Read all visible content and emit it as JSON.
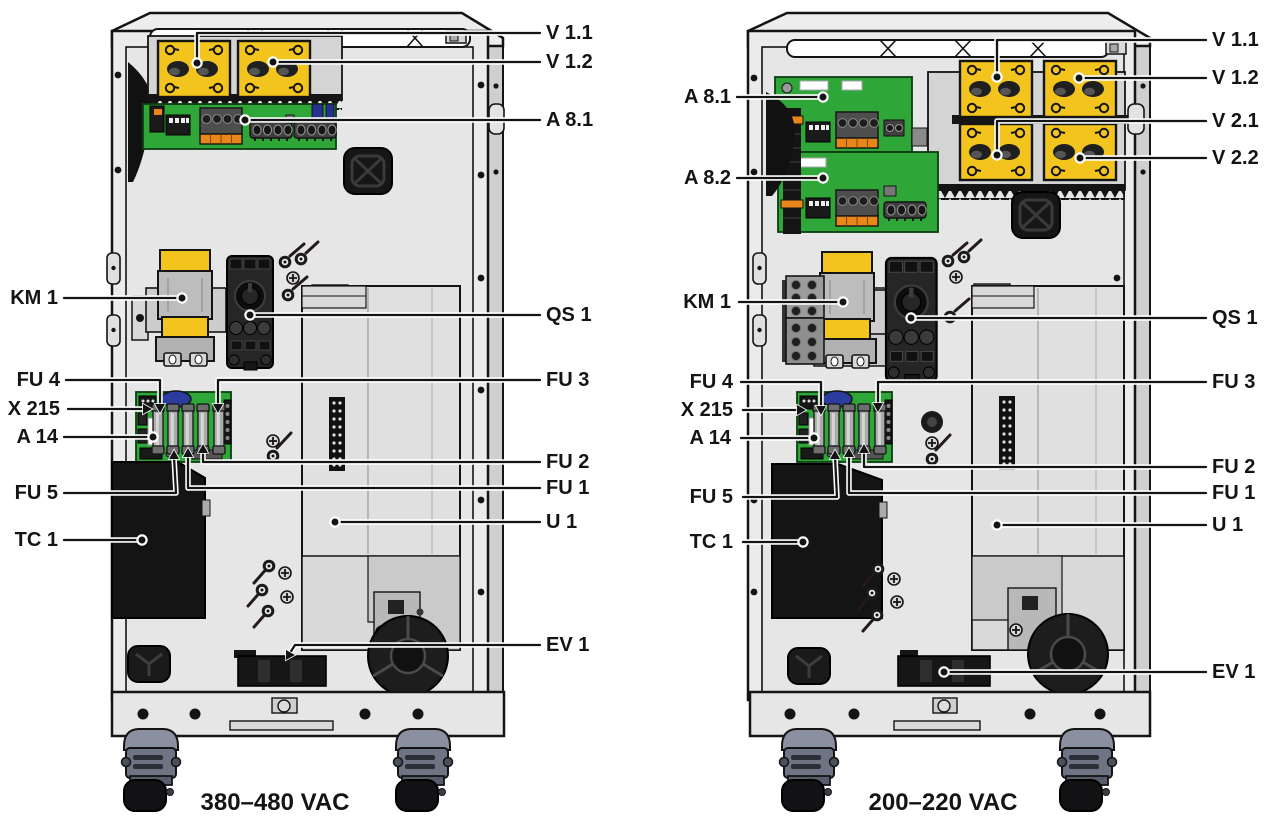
{
  "colors": {
    "yellow": "#F2C41D",
    "green": "#2FA638",
    "orange": "#E8861A",
    "ink": "#141414",
    "cab": "#EBEBEB",
    "interior": "#E6E6E6",
    "side": "#CFCFCF"
  },
  "diagram": {
    "left_unit": {
      "caption": "380–480 VAC",
      "labels": {
        "v1_1": "V 1.1",
        "v1_2": "V 1.2",
        "a8_1": "A 8.1",
        "km1": "KM 1",
        "qs1": "QS 1",
        "fu4": "FU 4",
        "fu3": "FU 3",
        "x215": "X 215",
        "a14": "A 14",
        "fu2": "FU 2",
        "fu5": "FU 5",
        "fu1": "FU 1",
        "u1": "U 1",
        "tc1": "TC 1",
        "ev1": "EV 1"
      }
    },
    "right_unit": {
      "caption": "200–220 VAC",
      "labels": {
        "v1_1": "V 1.1",
        "v1_2": "V 1.2",
        "v2_1": "V 2.1",
        "v2_2": "V 2.2",
        "a8_1": "A 8.1",
        "a8_2": "A 8.2",
        "km1": "KM 1",
        "qs1": "QS 1",
        "fu4": "FU 4",
        "fu3": "FU 3",
        "x215": "X 215",
        "a14": "A 14",
        "fu2": "FU 2",
        "fu5": "FU 5",
        "fu1": "FU 1",
        "u1": "U 1",
        "tc1": "TC 1",
        "ev1": "EV 1"
      }
    }
  }
}
